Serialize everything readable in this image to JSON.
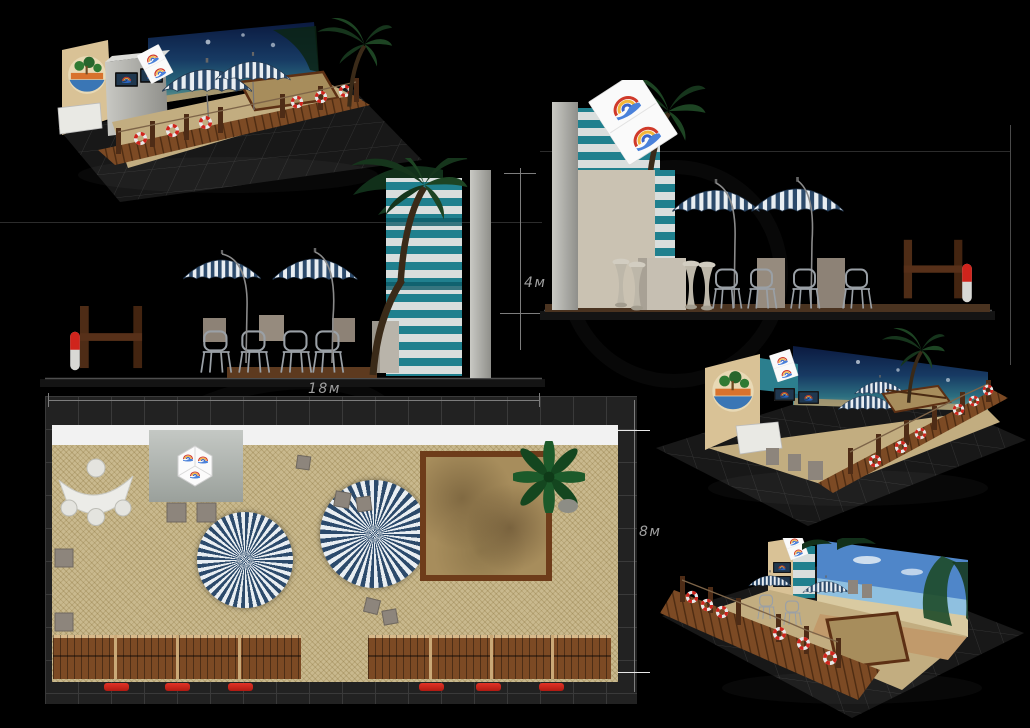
{
  "dimensions": {
    "width_label": "18м",
    "height_label": "4м",
    "depth_label": "8м"
  },
  "colors": {
    "background": "#000000",
    "umbrella_navy": "#2c4a6b",
    "umbrella_white": "#e9eef2",
    "wall_stripe_teal": "#20808e",
    "wall_stripe_light": "#d9dedd",
    "sand": "#a98d5c",
    "straw_floor": "#c9b98e",
    "deck_wood": "#7c4a24",
    "frame_wood": "#4e2c16",
    "lifebuoy_red": "#d0241c",
    "night_sky": "#0b1a40",
    "day_sky": "#4f86c9",
    "panel_grey": "#b5b5b0",
    "dimension_line": "#8a8a8a"
  }
}
